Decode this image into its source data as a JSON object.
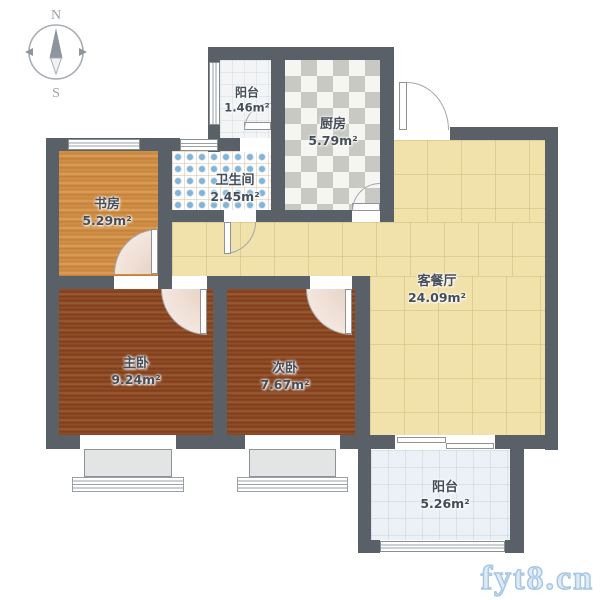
{
  "compass": {
    "north": "N",
    "south": "S"
  },
  "rooms": [
    {
      "id": "balcony-top",
      "name": "阳台",
      "area": "1.46m²"
    },
    {
      "id": "kitchen",
      "name": "厨房",
      "area": "5.79m²"
    },
    {
      "id": "bathroom",
      "name": "卫生间",
      "area": "2.45m²"
    },
    {
      "id": "study",
      "name": "书房",
      "area": "5.29m²"
    },
    {
      "id": "living-dining",
      "name": "客餐厅",
      "area": "24.09m²"
    },
    {
      "id": "master-bedroom",
      "name": "主卧",
      "area": "9.24m²"
    },
    {
      "id": "second-bedroom",
      "name": "次卧",
      "area": "7.67m²"
    },
    {
      "id": "balcony-bottom",
      "name": "阳台",
      "area": "5.26m²"
    }
  ],
  "watermark": {
    "text": "fyt8.cn"
  },
  "colors": {
    "wall": "#5a6067",
    "living_floor": "#f1e1ab",
    "study_floor": "#cc8a40",
    "bedroom_floor": "#8a4723",
    "kitchen_tile": "#c9c9c3",
    "bathroom_dot": "#82b4d8",
    "door_arc_fill": "#eedacd",
    "watermark_blue": "#a9c7e2"
  }
}
